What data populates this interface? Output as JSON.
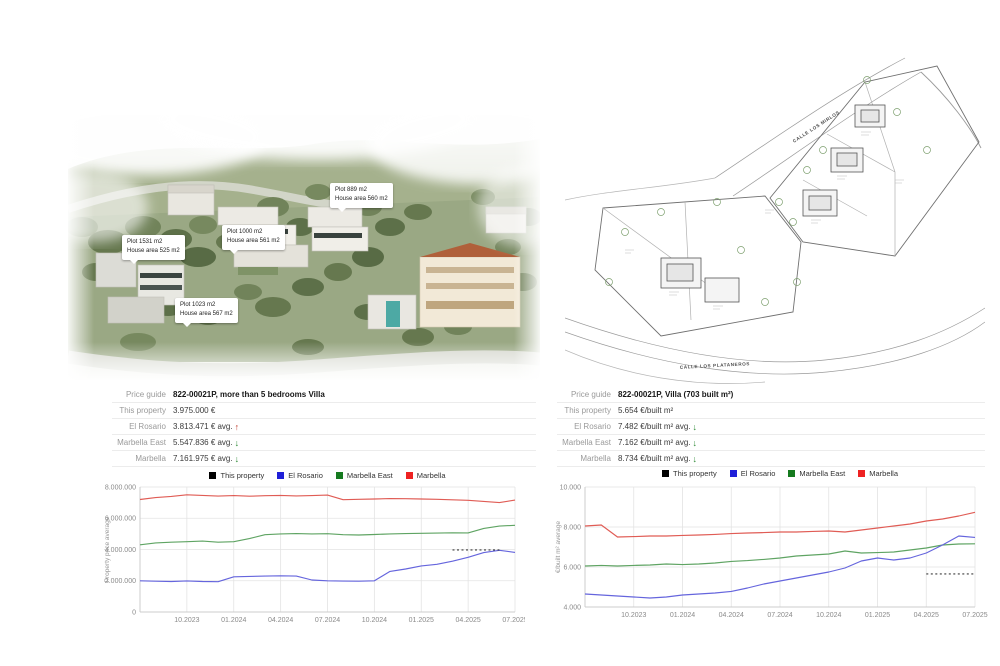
{
  "aerial": {
    "plot_labels": [
      {
        "line1": "Plot 1531 m2",
        "line2": "House area 525 m2"
      },
      {
        "line1": "Plot 1000 m2",
        "line2": "House area 561 m2"
      },
      {
        "line1": "Plot 889 m2",
        "line2": "House area 560 m2"
      },
      {
        "line1": "Plot 1023 m2",
        "line2": "House area 567 m2"
      }
    ]
  },
  "siteplan": {
    "street_top": "CALLE LOS MIRLOS",
    "street_bottom": "CALLE LOS PLATANEROS"
  },
  "arrow_symbols": {
    "up": "↑",
    "down": "↓"
  },
  "colors": {
    "arrow_up": "#c03a2b",
    "arrow_down": "#2e8a35",
    "grid": "#e3e3e3",
    "axis": "#cccccc",
    "tick_text": "#8a8a8a"
  },
  "tables": {
    "left": {
      "rows": [
        {
          "label": "Price guide",
          "value": "822-00021P, more than 5 bedrooms Villa",
          "bold": true
        },
        {
          "label": "This property",
          "value": "3.975.000 €"
        },
        {
          "label": "El Rosario",
          "value": "3.813.471 € avg.",
          "arrow": "up"
        },
        {
          "label": "Marbella East",
          "value": "5.547.836 € avg.",
          "arrow": "down"
        },
        {
          "label": "Marbella",
          "value": "7.161.975 € avg.",
          "arrow": "down"
        }
      ]
    },
    "right": {
      "rows": [
        {
          "label": "Price guide",
          "value": "822-00021P, Villa (703 built m²)",
          "bold": true
        },
        {
          "label": "This property",
          "value": "5.654 €/built m²"
        },
        {
          "label": "El Rosario",
          "value": "7.482 €/built m² avg.",
          "arrow": "down"
        },
        {
          "label": "Marbella East",
          "value": "7.162 €/built m² avg.",
          "arrow": "down"
        },
        {
          "label": "Marbella",
          "value": "8.734 €/built m² avg.",
          "arrow": "down"
        }
      ]
    }
  },
  "chart_data": [
    {
      "type": "line",
      "ylabel": "Property price average",
      "ylim": [
        0,
        8000000
      ],
      "grid": true,
      "legend_position": "top",
      "yticks": [
        {
          "v": 0,
          "label": "0"
        },
        {
          "v": 2000000,
          "label": "2.000.000"
        },
        {
          "v": 4000000,
          "label": "4.000.000"
        },
        {
          "v": 6000000,
          "label": "6.000.000"
        },
        {
          "v": 8000000,
          "label": "8.000.000"
        }
      ],
      "x": [
        "07.2023",
        "08.2023",
        "09.2023",
        "10.2023",
        "11.2023",
        "12.2023",
        "01.2024",
        "02.2024",
        "03.2024",
        "04.2024",
        "05.2024",
        "06.2024",
        "07.2024",
        "08.2024",
        "09.2024",
        "10.2024",
        "11.2024",
        "12.2024",
        "01.2025",
        "02.2025",
        "03.2025",
        "04.2025",
        "05.2025",
        "06.2025",
        "07.2025"
      ],
      "xticks": [
        {
          "i": 3,
          "label": "10.2023"
        },
        {
          "i": 6,
          "label": "01.2024"
        },
        {
          "i": 9,
          "label": "04.2024"
        },
        {
          "i": 12,
          "label": "07.2024"
        },
        {
          "i": 15,
          "label": "10.2024"
        },
        {
          "i": 18,
          "label": "01.2025"
        },
        {
          "i": 21,
          "label": "04.2025"
        },
        {
          "i": 24,
          "label": "07.2025"
        }
      ],
      "series": [
        {
          "name": "This property",
          "legend_color": "#000000",
          "line_color": "#3c3c3c",
          "dashed": true,
          "values": [
            null,
            null,
            null,
            null,
            null,
            null,
            null,
            null,
            null,
            null,
            null,
            null,
            null,
            null,
            null,
            null,
            null,
            null,
            null,
            null,
            3975000,
            3975000,
            3975000,
            3975000,
            null
          ]
        },
        {
          "name": "El Rosario",
          "legend_color": "#1f1fd8",
          "line_color": "#6565dd",
          "values": [
            2000000,
            1970000,
            1950000,
            1990000,
            1950000,
            1940000,
            2250000,
            2280000,
            2300000,
            2320000,
            2300000,
            2050000,
            2000000,
            1980000,
            1970000,
            2000000,
            2600000,
            2750000,
            2950000,
            3050000,
            3250000,
            3500000,
            3800000,
            3950000,
            3813471
          ]
        },
        {
          "name": "Marbella East",
          "legend_color": "#157a1f",
          "line_color": "#5fa463",
          "values": [
            4300000,
            4420000,
            4470000,
            4500000,
            4540000,
            4470000,
            4500000,
            4700000,
            4950000,
            5000000,
            5020000,
            5000000,
            5010000,
            4950000,
            4930000,
            4960000,
            5000000,
            5020000,
            5040000,
            5050000,
            5070000,
            5060000,
            5350000,
            5500000,
            5547836
          ]
        },
        {
          "name": "Marbella",
          "legend_color": "#ee2222",
          "line_color": "#e05c55",
          "values": [
            7200000,
            7320000,
            7400000,
            7500000,
            7460000,
            7420000,
            7450000,
            7410000,
            7440000,
            7460000,
            7430000,
            7450000,
            7480000,
            7190000,
            7210000,
            7230000,
            7260000,
            7250000,
            7230000,
            7210000,
            7180000,
            7150000,
            7080000,
            7000000,
            7161975
          ]
        }
      ]
    },
    {
      "type": "line",
      "ylabel": "€/built m² average",
      "ylim": [
        4000,
        10000
      ],
      "grid": true,
      "legend_position": "top",
      "yticks": [
        {
          "v": 4000,
          "label": "4.000"
        },
        {
          "v": 6000,
          "label": "6.000"
        },
        {
          "v": 8000,
          "label": "8.000"
        },
        {
          "v": 10000,
          "label": "10.000"
        }
      ],
      "x": [
        "07.2023",
        "08.2023",
        "09.2023",
        "10.2023",
        "11.2023",
        "12.2023",
        "01.2024",
        "02.2024",
        "03.2024",
        "04.2024",
        "05.2024",
        "06.2024",
        "07.2024",
        "08.2024",
        "09.2024",
        "10.2024",
        "11.2024",
        "12.2024",
        "01.2025",
        "02.2025",
        "03.2025",
        "04.2025",
        "05.2025",
        "06.2025",
        "07.2025"
      ],
      "xticks": [
        {
          "i": 3,
          "label": "10.2023"
        },
        {
          "i": 6,
          "label": "01.2024"
        },
        {
          "i": 9,
          "label": "04.2024"
        },
        {
          "i": 12,
          "label": "07.2024"
        },
        {
          "i": 15,
          "label": "10.2024"
        },
        {
          "i": 18,
          "label": "01.2025"
        },
        {
          "i": 21,
          "label": "04.2025"
        },
        {
          "i": 24,
          "label": "07.2025"
        }
      ],
      "series": [
        {
          "name": "This property",
          "legend_color": "#000000",
          "line_color": "#3c3c3c",
          "dashed": true,
          "values": [
            null,
            null,
            null,
            null,
            null,
            null,
            null,
            null,
            null,
            null,
            null,
            null,
            null,
            null,
            null,
            null,
            null,
            null,
            null,
            null,
            null,
            5654,
            5654,
            5654,
            5654
          ]
        },
        {
          "name": "El Rosario",
          "legend_color": "#1f1fd8",
          "line_color": "#6565dd",
          "values": [
            4650,
            4600,
            4550,
            4500,
            4450,
            4500,
            4600,
            4650,
            4700,
            4780,
            4950,
            5150,
            5300,
            5450,
            5600,
            5750,
            5950,
            6300,
            6450,
            6350,
            6450,
            6700,
            7100,
            7550,
            7482
          ]
        },
        {
          "name": "Marbella East",
          "legend_color": "#157a1f",
          "line_color": "#5fa463",
          "values": [
            6050,
            6080,
            6050,
            6080,
            6100,
            6150,
            6120,
            6150,
            6200,
            6280,
            6320,
            6380,
            6450,
            6550,
            6600,
            6650,
            6800,
            6700,
            6720,
            6750,
            6850,
            6950,
            7100,
            7150,
            7162
          ]
        },
        {
          "name": "Marbella",
          "legend_color": "#ee2222",
          "line_color": "#e05c55",
          "values": [
            8050,
            8100,
            7500,
            7520,
            7550,
            7550,
            7580,
            7600,
            7630,
            7670,
            7700,
            7720,
            7750,
            7750,
            7780,
            7800,
            7750,
            7850,
            7950,
            8050,
            8150,
            8300,
            8400,
            8550,
            8734
          ]
        }
      ]
    }
  ]
}
